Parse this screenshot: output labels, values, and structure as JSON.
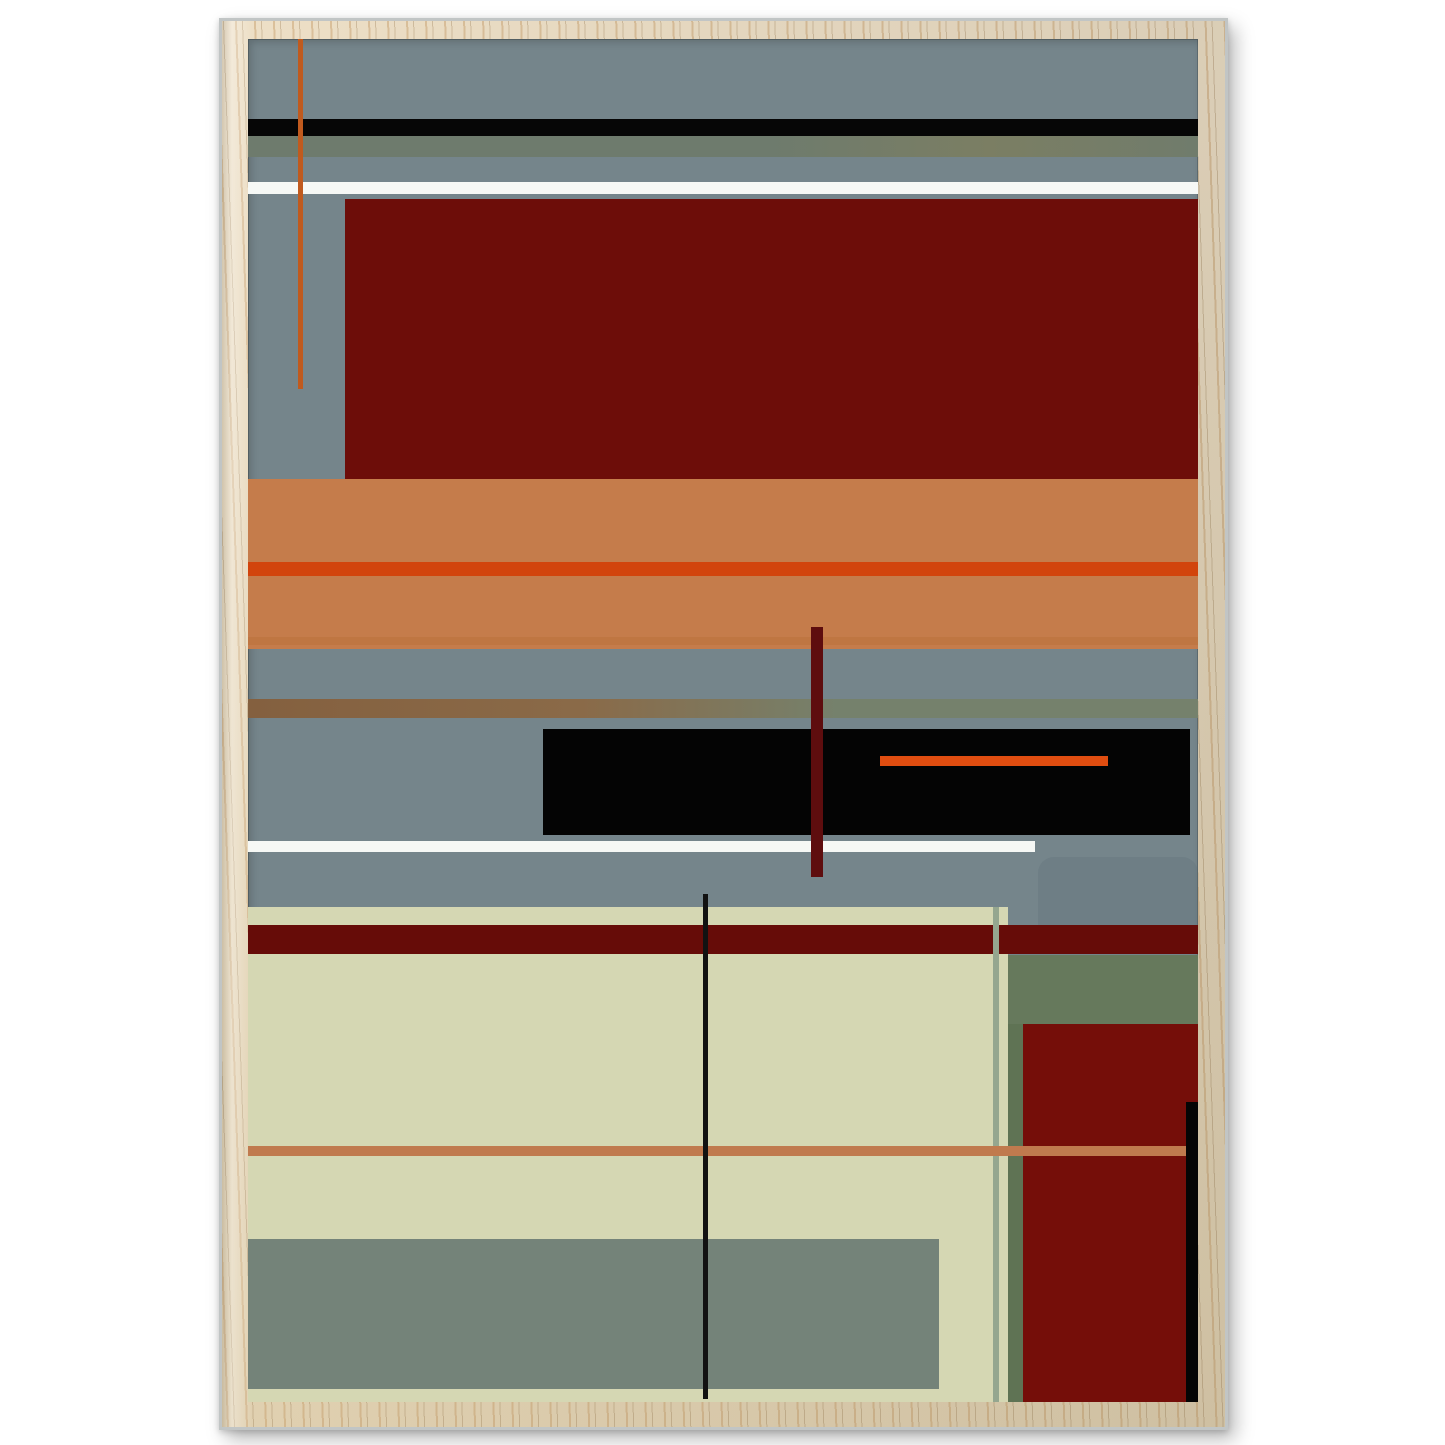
{
  "canvas": {
    "background": "#ffffff",
    "width": 1445,
    "height": 1445
  },
  "frame": {
    "outer_edge_color": "#c1c5c5",
    "wood_light": "#eddfc6",
    "wood_dark": "#e0d0b0",
    "grain_light": "rgba(196,154,102,0.45)",
    "grain_dark": "rgba(140,108,66,0.30)",
    "shadow_color": "rgba(0,0,0,0.28)"
  },
  "artwork": {
    "background_color": "#75858b",
    "shapes": [
      {
        "name": "top-black-band",
        "x": 0,
        "y": 80,
        "w": 950,
        "h": 17,
        "color": "#060606"
      },
      {
        "name": "top-olive-band",
        "x": 0,
        "y": 97,
        "w": 950,
        "h": 21,
        "gradient": "linear-gradient(90deg, #6e7b6d 0%, #6e7b6d 55%, #7b7e63 78%, #707c6c 100%)"
      },
      {
        "name": "top-white-band",
        "x": 0,
        "y": 143,
        "w": 950,
        "h": 12,
        "color": "#f6f8f5"
      },
      {
        "name": "large-dark-red-rect",
        "x": 97,
        "y": 160,
        "w": 853,
        "h": 280,
        "color": "#6d0d09"
      },
      {
        "name": "tan-band",
        "x": 0,
        "y": 440,
        "w": 950,
        "h": 170,
        "color": "#c57c4b"
      },
      {
        "name": "orange-red-line",
        "x": 0,
        "y": 523,
        "w": 950,
        "h": 14,
        "color": "#d2440c"
      },
      {
        "name": "tan-shadow-line",
        "x": 0,
        "y": 598,
        "w": 950,
        "h": 8,
        "color": "#b96f38",
        "opacity": 0.45
      },
      {
        "name": "brown-texture-stripe",
        "x": 0,
        "y": 660,
        "w": 950,
        "h": 19,
        "gradient": "linear-gradient(90deg, #84603f 0%, #8a6a48 35%, #75816c 62%, #75816c 100%)"
      },
      {
        "name": "mid-black-rect",
        "x": 295,
        "y": 690,
        "w": 647,
        "h": 106,
        "color": "#040404"
      },
      {
        "name": "black-rect-orange-line",
        "x": 632,
        "y": 717,
        "w": 228,
        "h": 10,
        "color": "#e04d10"
      },
      {
        "name": "mid-white-line",
        "x": 0,
        "y": 802,
        "w": 787,
        "h": 11,
        "color": "#f6f8f5"
      },
      {
        "name": "rounded-gray-shape",
        "x": 790,
        "y": 818,
        "w": 160,
        "h": 68,
        "color": "#566a70",
        "opacity": 0.22,
        "radius": "16px 16px 0 0"
      },
      {
        "name": "cream-region",
        "x": 0,
        "y": 868,
        "w": 760,
        "h": 495,
        "color": "#d5d7b3"
      },
      {
        "name": "bottom-gray-band",
        "x": 0,
        "y": 1200,
        "w": 691,
        "h": 150,
        "color": "#748379"
      },
      {
        "name": "sage-right-region",
        "x": 760,
        "y": 916,
        "w": 190,
        "h": 69,
        "color": "#66795c"
      },
      {
        "name": "sage-column",
        "x": 760,
        "y": 985,
        "w": 15,
        "h": 378,
        "color": "#5f7354"
      },
      {
        "name": "bottom-dark-red-rect",
        "x": 775,
        "y": 985,
        "w": 175,
        "h": 378,
        "color": "#750e09"
      },
      {
        "name": "dark-red-band",
        "x": 0,
        "y": 886,
        "w": 950,
        "h": 29,
        "color": "#660c08"
      },
      {
        "name": "pale-green-vline",
        "x": 745,
        "y": 868,
        "w": 6,
        "h": 495,
        "color": "#95a68f"
      },
      {
        "name": "bottom-tan-line",
        "x": 0,
        "y": 1107,
        "w": 938,
        "h": 10,
        "color": "#c07a4e"
      },
      {
        "name": "bottom-black-bar",
        "x": 938,
        "y": 1063,
        "w": 12,
        "h": 300,
        "color": "#050505"
      },
      {
        "name": "maroon-vbar",
        "x": 563,
        "y": 588,
        "w": 12,
        "h": 250,
        "color": "#5e0d0e"
      },
      {
        "name": "black-thin-vline",
        "x": 455,
        "y": 855,
        "w": 5,
        "h": 505,
        "color": "#121212"
      },
      {
        "name": "orange-vline",
        "x": 50,
        "y": 0,
        "w": 5,
        "h": 350,
        "color": "#c05a1e"
      }
    ]
  }
}
